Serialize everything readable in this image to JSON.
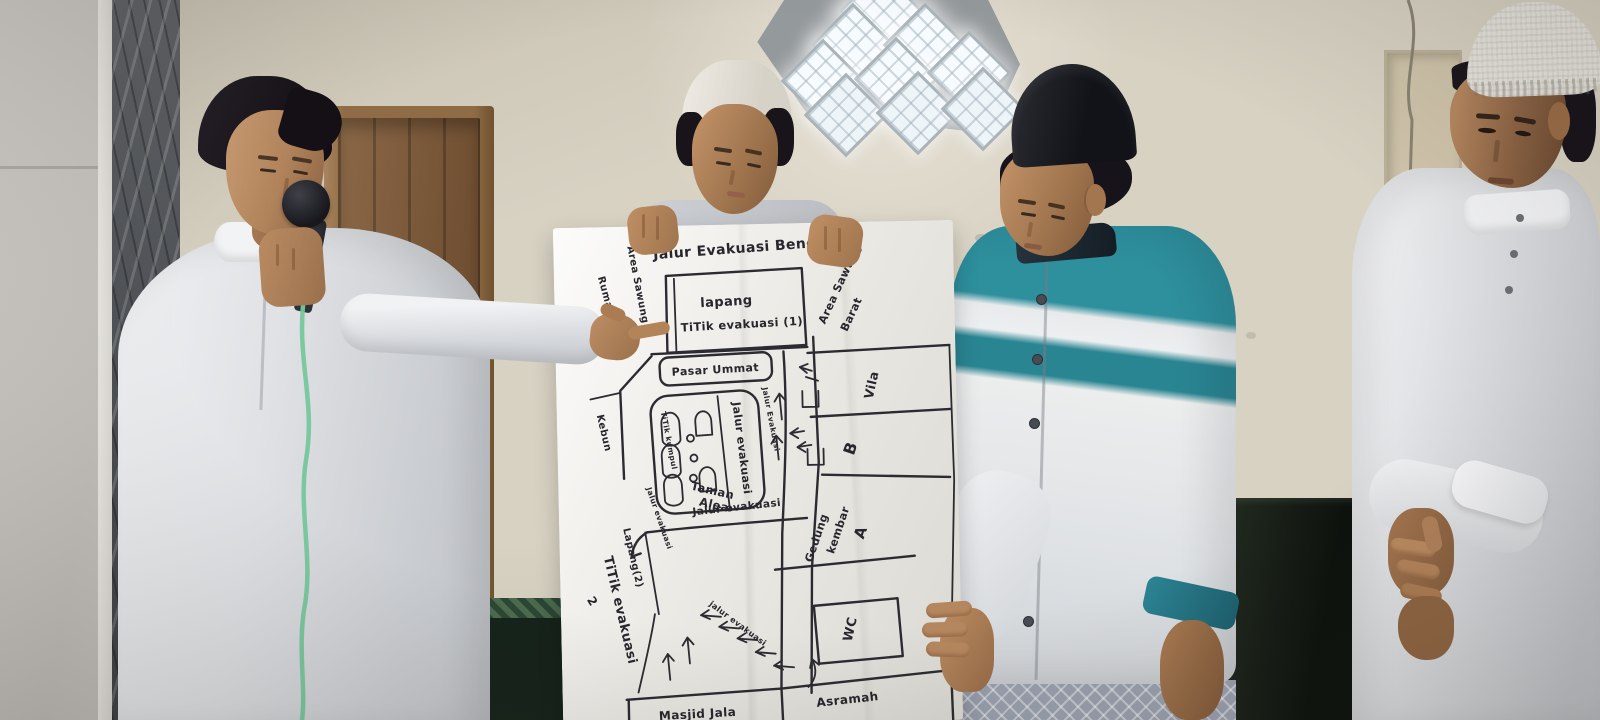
{
  "map": {
    "title": "Jalur Evakuasi Bencana",
    "labels": {
      "rumah": "Rumah",
      "area_sawung": "Area Sawung",
      "lapang_titik1_line1": "lapang",
      "lapang_titik1_line2": "TiTik evakuasi (1)",
      "area_sawung_barat_line1": "Area Sawung",
      "area_sawung_barat_line2": "Barat",
      "pasar_ummat": "Pasar Ummat",
      "kebun": "Kebun",
      "titik_kumpul": "TiTik kumpul",
      "jalur_evakuasi_taman": "Jalur evakuasi",
      "taman_line1": "Taman",
      "taman_line2": "Alea",
      "jalur_evakuasi_vertical": "Jalur Evakuasi",
      "jalur_evakuasi_diagonal": "Jalur evakuasi",
      "vila": "Vila",
      "blok_b": "B",
      "gedung_line1": "Gedung",
      "gedung_line2": "kembar",
      "gedung_line3": "A",
      "wc": "WC",
      "jalur_evakuasi_mid": "Jalur evakuasi",
      "lapang_2": "Lapang(2)",
      "titik_evakuasi_2": "TiTik evakuasi",
      "titik_evakuasi_2_num": "2",
      "jalur_evakuasi_bottom": "jalur evakuasi",
      "masjid_jala": "Masjid Jala",
      "asramah": "Asramah"
    }
  },
  "colors": {
    "wall": "#d8d2c3",
    "paper": "#eceae5",
    "marker_ink": "#26262c",
    "door_wood": "#84623f",
    "marble_dark": "#54575b",
    "marble_light": "#c9c6c0",
    "robe_white": "#e6e7e9",
    "shirt_teal": "#2e8f9d",
    "shirt_teal_dark": "#1f6b77",
    "songkok_black": "#131418",
    "mic_cable_green": "#76c79c",
    "bench_green": "#1a2a1e",
    "skin": "#b5875e"
  }
}
